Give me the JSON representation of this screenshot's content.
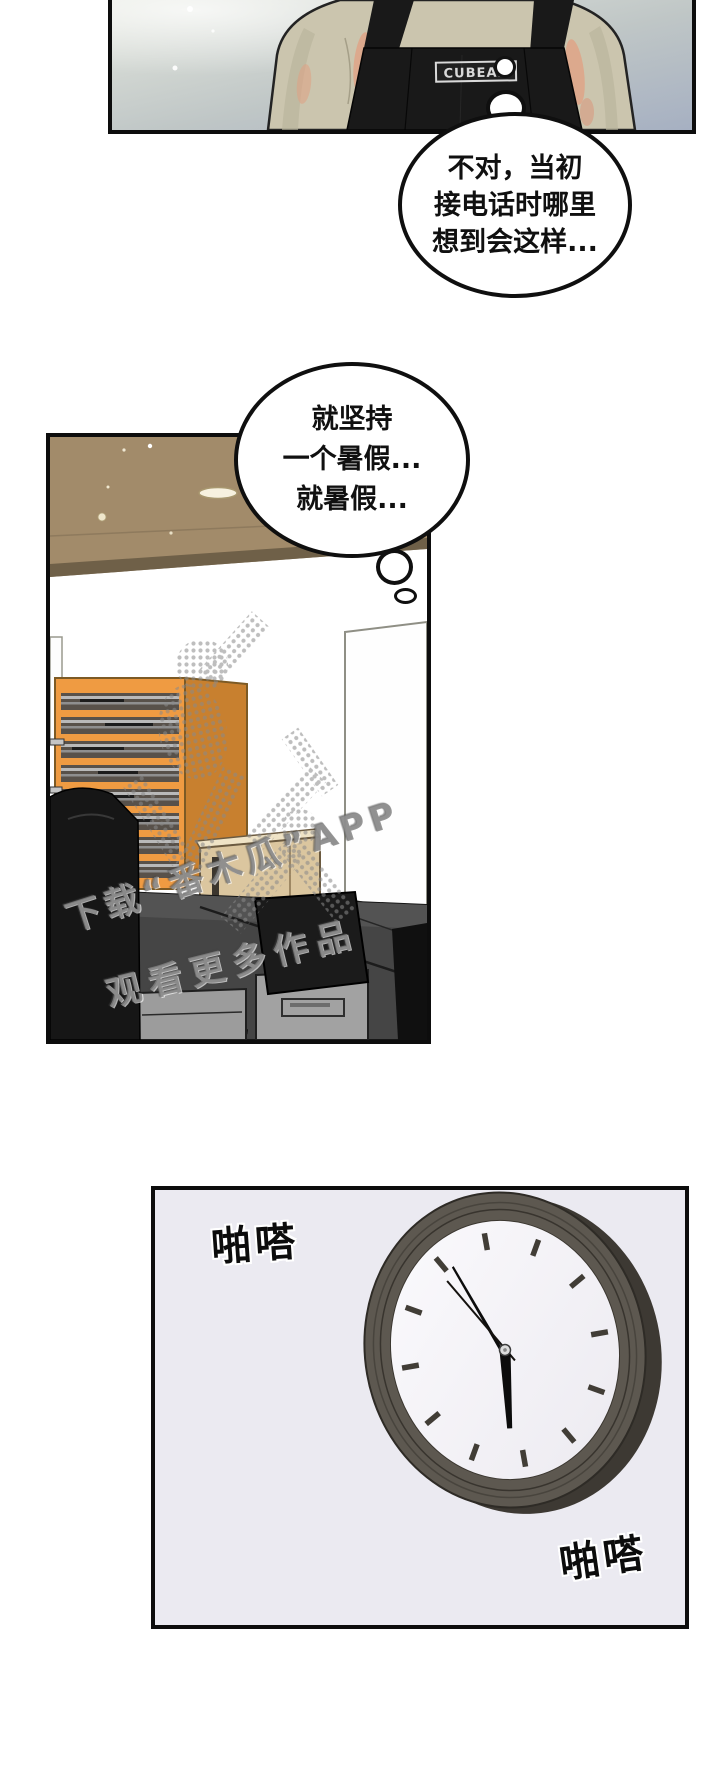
{
  "comic": {
    "panel1": {
      "apron_tag_label": "CUBEAR"
    },
    "speech_bubble_1": {
      "line1": "不对，当初",
      "line2": "接电话时哪里",
      "line3": "想到会这样..."
    },
    "speech_bubble_2": {
      "line1": "就坚持",
      "line2": "一个暑假...",
      "line3": "就暑假..."
    },
    "watermark": {
      "line1": "下载“番木瓜”APP",
      "line2": "观看更多作品"
    },
    "sfx": {
      "tick_top_left": "啪嗒",
      "tick_bottom_right": "啪嗒"
    },
    "clock": {
      "time_shown": "5:55"
    },
    "colors": {
      "panel_border": "#0d0d0d",
      "panel1_bg_top": "#e2e5dd",
      "panel1_bg_bottom": "#a8b2c2",
      "shirt": "#cbc5ae",
      "apron": "#191919",
      "ceiling": "#a28b6a",
      "shelf_front": "#ef9b42",
      "shelf_side": "#c8802f",
      "cabinet": "#dbc69f",
      "desk": "#454545",
      "drawer": "#9c9c9c",
      "clock_rim": "#5d5850",
      "clock_face": "#f6f5f8",
      "panel3_bg": "#ebeaf1",
      "watermark_gray": "#808080"
    }
  }
}
